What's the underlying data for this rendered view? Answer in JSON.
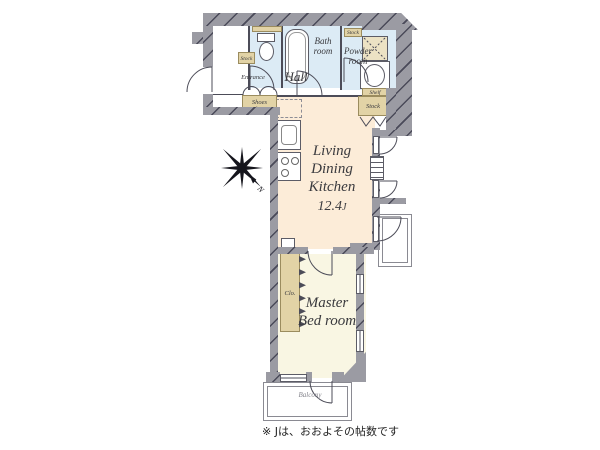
{
  "plan": {
    "rooms": {
      "ldk": {
        "name_line1": "Living",
        "name_line2": "Dining",
        "name_line3": "Kitchen",
        "size_value": "12.4",
        "size_unit": "J"
      },
      "master_bedroom": {
        "name_line1": "Master",
        "name_line2": "Bed room"
      },
      "hall": {
        "name": "Hall"
      },
      "entrance": {
        "name": "Entrance"
      },
      "shoes_closet": {
        "name": "Shoes Closet"
      },
      "bath_room": {
        "name_line1": "Bath",
        "name_line2": "room"
      },
      "powder_room": {
        "name_line1": "Powder",
        "name_line2": "room"
      },
      "closet": {
        "name": "Clo."
      },
      "balcony": {
        "name": "Balcony"
      },
      "stock_entrance": {
        "name": "Stock"
      },
      "stock_powder_top": {
        "name": "Stock"
      },
      "stock_ldk": {
        "name": "Stock"
      },
      "shelf": {
        "name": "Shelf"
      }
    },
    "compass": {
      "north": "N"
    },
    "footnote": "※ Jは、おおよその帖数です",
    "colors": {
      "wall": "#9b9ba3",
      "ldk_floor": "#fcecd8",
      "bedroom_floor": "#f9f6e3",
      "wet_floor": "#dcebf5",
      "closet_tan": "#e2d3a6",
      "outline": "#4c4c58"
    }
  }
}
